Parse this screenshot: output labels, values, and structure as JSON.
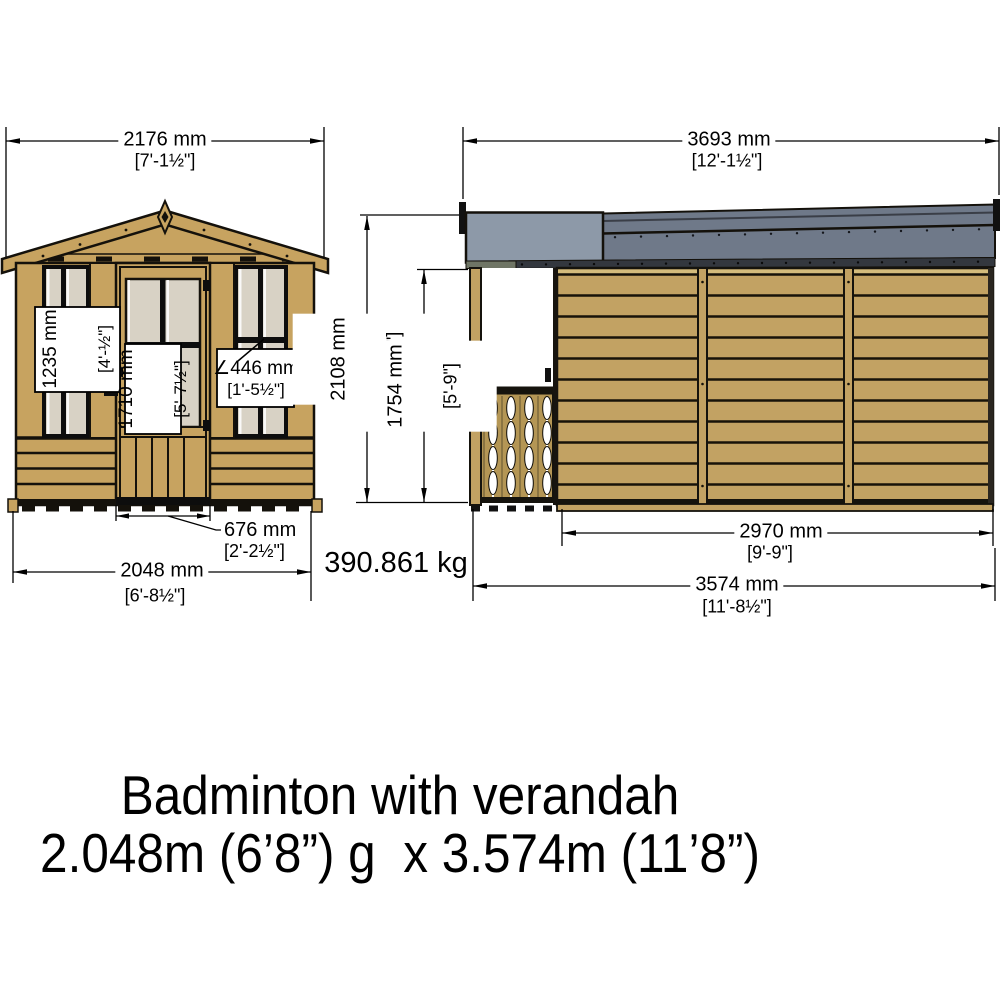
{
  "document_type": "shed elevation dimension drawing",
  "front_view": {
    "name": "front elevation (gable end with door and verandah windows)",
    "top_dim": {
      "value": "2176 mm",
      "imperial": "[7'-1½\"]"
    },
    "window_height_label": {
      "value": "1235 mm",
      "imperial": "[4'-½\"]"
    },
    "door_height_label": {
      "value": "1710 mm",
      "imperial": "[5'-7½\"]"
    },
    "window_width_label": {
      "value": "∠446 mm",
      "imperial": "[1'-5½\"]"
    },
    "door_width_dim": {
      "value": "676 mm",
      "imperial": "[2'-2½\"]"
    },
    "base_dim": {
      "value": "2048 mm",
      "imperial": "[6'-8½\"]"
    }
  },
  "side_view": {
    "name": "side elevation (verandah with balustrade and clad wall)",
    "top_dim": {
      "value": "3693 mm",
      "imperial": "[12'-1½\"]"
    },
    "overall_height_dim": {
      "value": "2108 mm",
      "imperial": "[6'-11\"]"
    },
    "eaves_height_dim": {
      "value": "1754 mm",
      "imperial": "[5'-9\"]"
    },
    "wall_length_dim": {
      "value": "2970 mm",
      "imperial": "[9'-9\"]"
    },
    "base_dim": {
      "value": "3574 mm",
      "imperial": "[11'-8½\"]"
    }
  },
  "weight": {
    "value": "390.861 kg"
  },
  "title": {
    "line1": "Badminton with verandah",
    "line2": "2.048m (6’8”) g  x 3.574m (11’8”)"
  },
  "colors": {
    "wood": "#c7a360",
    "wood_light": "#d4bc7c",
    "baluster_wood": "#b49655",
    "glass": "#d8d2c5",
    "roof_verandah": "#8d99a8",
    "roof_main": "#6f7989",
    "fascia_dark": "#33373e",
    "fascia_olive": "#6f7565",
    "line": "#000000"
  }
}
